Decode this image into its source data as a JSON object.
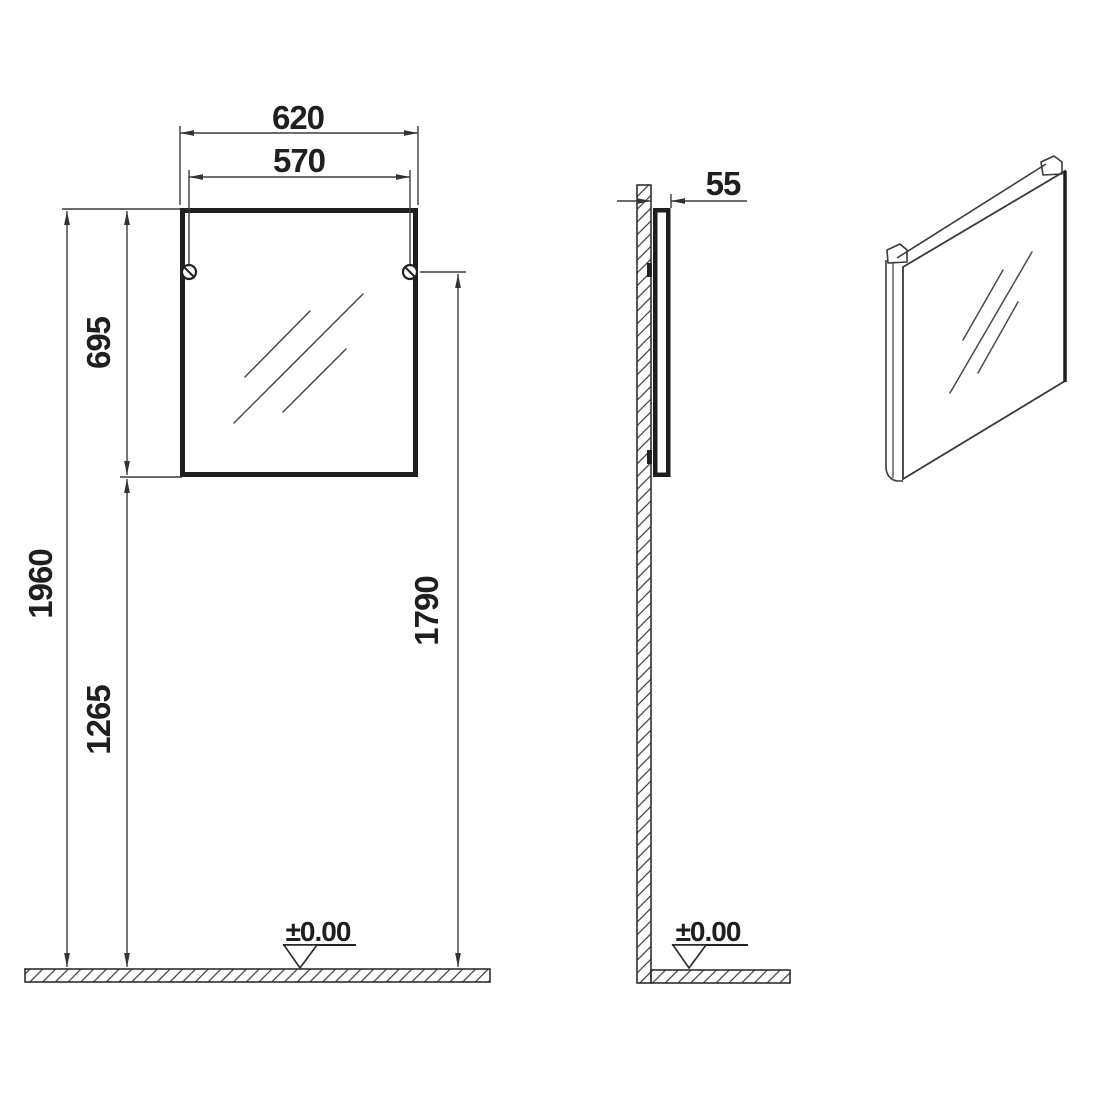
{
  "dimensions": {
    "front": {
      "outer_width": "620",
      "mounting_width": "570",
      "mirror_height": "695",
      "total_height": "1960",
      "floor_to_mirror_bottom": "1265",
      "floor_to_mounting": "1790",
      "floor_datum": "±0.00"
    },
    "side": {
      "depth": "55",
      "floor_datum": "±0.00"
    }
  },
  "colors": {
    "background": "#ffffff",
    "line": "#3c3c3c",
    "heavy_line": "#1e1e1e",
    "text": "#1f1f1f"
  }
}
